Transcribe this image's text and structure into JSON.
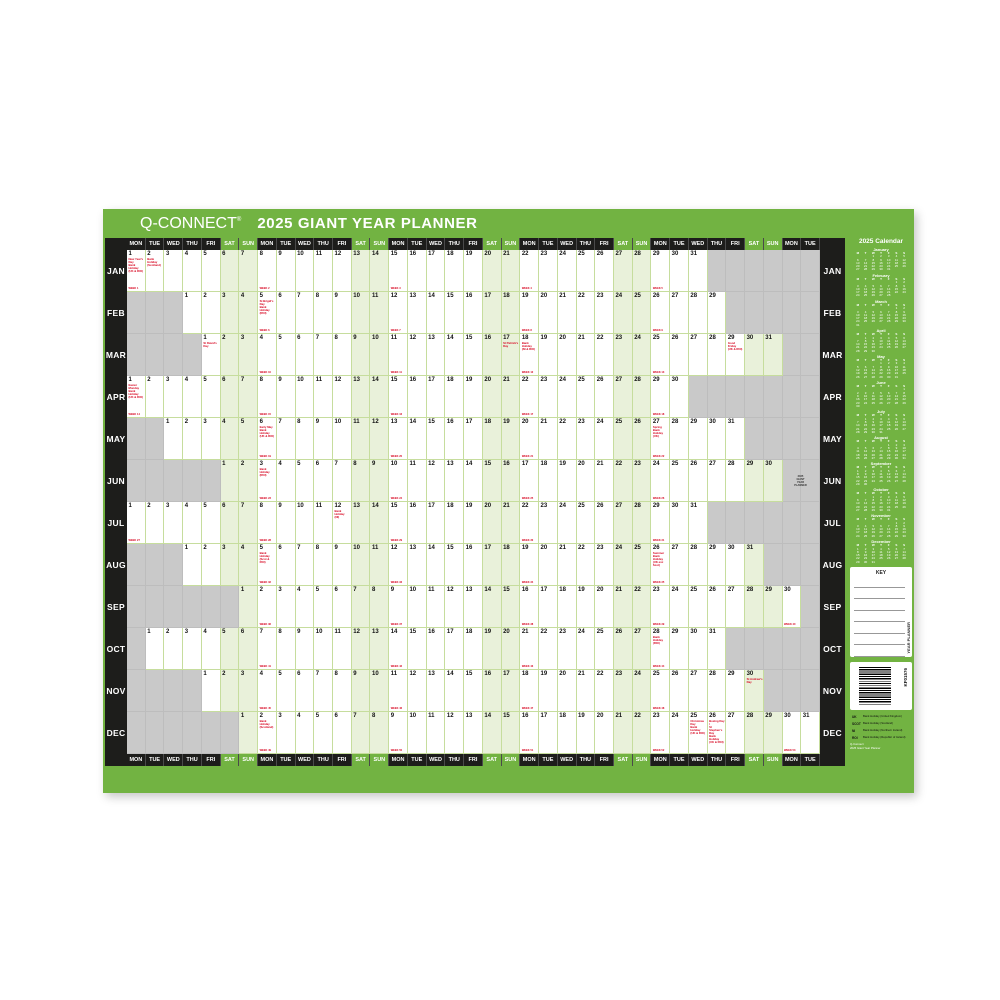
{
  "title": {
    "brand": "Q-CONNECT",
    "reg": "®",
    "heading": "2025 GIANT YEAR PLANNER"
  },
  "colors": {
    "green": "#72b342",
    "black": "#1d1d1b",
    "weekend_tint": "#e9f1da",
    "inactive_gray": "#c9c9c9",
    "holiday_red": "#d6001c",
    "cell_border": "#c6dd9d"
  },
  "day_names": [
    "MON",
    "TUE",
    "WED",
    "THU",
    "FRI",
    "SAT",
    "SUN"
  ],
  "num_columns": 37,
  "week_label": "WEEK",
  "months": [
    {
      "label": "JAN",
      "start_col": 1,
      "days": 31,
      "holidays": {
        "1": [
          "New Year's Day",
          "Bank Holiday",
          "(UK & ROI)"
        ],
        "2": [
          "Bank Holiday",
          "(Scotland)"
        ]
      }
    },
    {
      "label": "FEB",
      "start_col": 4,
      "days": 29,
      "holidays": {
        "5": [
          "St Brigid's Day",
          "Bank Holiday",
          "(ROI)"
        ]
      }
    },
    {
      "label": "MAR",
      "start_col": 5,
      "days": 31,
      "holidays": {
        "1": [
          "St David's Day"
        ],
        "17": [
          "St Patrick's Day"
        ],
        "18": [
          "Bank Holiday",
          "(NI & ROI)"
        ],
        "29": [
          "Good Friday",
          "(UK & ROI)"
        ]
      }
    },
    {
      "label": "APR",
      "start_col": 1,
      "days": 30,
      "holidays": {
        "1": [
          "Easter Monday",
          "Bank Holiday",
          "(UK & ROI)"
        ]
      }
    },
    {
      "label": "MAY",
      "start_col": 3,
      "days": 31,
      "holidays": {
        "6": [
          "Early May",
          "Bank Holiday",
          "(UK & ROI)"
        ],
        "27": [
          "Spring",
          "Bank Holiday",
          "(UK)"
        ]
      }
    },
    {
      "label": "JUN",
      "start_col": 6,
      "days": 30,
      "holidays": {
        "3": [
          "Bank Holiday",
          "(ROI)"
        ]
      }
    },
    {
      "label": "JUL",
      "start_col": 1,
      "days": 31,
      "holidays": {
        "12": [
          "Bank Holiday",
          "(NI)"
        ]
      }
    },
    {
      "label": "AUG",
      "start_col": 4,
      "days": 31,
      "holidays": {
        "5": [
          "Bank Holiday",
          "(Scot & ROI)"
        ],
        "26": [
          "Summer",
          "Bank Holiday",
          "(UK exc Scot)"
        ]
      }
    },
    {
      "label": "SEP",
      "start_col": 7,
      "days": 30,
      "holidays": {}
    },
    {
      "label": "OCT",
      "start_col": 2,
      "days": 31,
      "holidays": {
        "28": [
          "Bank Holiday",
          "(ROI)"
        ]
      }
    },
    {
      "label": "NOV",
      "start_col": 5,
      "days": 30,
      "holidays": {
        "30": [
          "St Andrew's Day"
        ]
      }
    },
    {
      "label": "DEC",
      "start_col": 7,
      "days": 31,
      "holidays": {
        "2": [
          "Bank Holiday",
          "(Scotland)"
        ],
        "25": [
          "Christmas Day",
          "Bank Holiday",
          "(UK & ROI)"
        ],
        "26": [
          "Boxing Day /",
          "St Stephen's Day",
          "Bank Holiday",
          "(UK & ROI)"
        ]
      }
    }
  ],
  "note_block": {
    "lines": [
      "2025",
      "GIANT",
      "YEAR",
      "PLANNER"
    ]
  },
  "sidebar": {
    "calendar_title": "2025 Calendar",
    "mini_week_header": [
      "M",
      "T",
      "W",
      "T",
      "F",
      "S",
      "S"
    ],
    "mini_months": [
      {
        "name": "January",
        "start_dow": 2,
        "days": 31
      },
      {
        "name": "February",
        "start_dow": 5,
        "days": 28
      },
      {
        "name": "March",
        "start_dow": 5,
        "days": 31
      },
      {
        "name": "April",
        "start_dow": 1,
        "days": 30
      },
      {
        "name": "May",
        "start_dow": 3,
        "days": 31
      },
      {
        "name": "June",
        "start_dow": 6,
        "days": 30
      },
      {
        "name": "July",
        "start_dow": 1,
        "days": 31
      },
      {
        "name": "August",
        "start_dow": 4,
        "days": 31
      },
      {
        "name": "September",
        "start_dow": 0,
        "days": 30
      },
      {
        "name": "October",
        "start_dow": 2,
        "days": 31
      },
      {
        "name": "November",
        "start_dow": 5,
        "days": 30
      },
      {
        "name": "December",
        "start_dow": 0,
        "days": 31
      }
    ],
    "key": {
      "title": "KEY",
      "line_count": 7,
      "side_label": "YEAR PLANNER"
    },
    "barcode_code": "KF01576",
    "legend": [
      {
        "abbr": "UK",
        "text": "Bank Holiday (United Kingdom)"
      },
      {
        "abbr": "SCOT",
        "text": "Bank Holiday (Scotland)"
      },
      {
        "abbr": "NI",
        "text": "Bank Holiday (Northern Ireland)"
      },
      {
        "abbr": "ROI",
        "text": "Bank Holiday (Republic of Ireland)"
      }
    ],
    "footer_lines": [
      "Q-Connect",
      "2025 Giant Year Planner"
    ]
  }
}
